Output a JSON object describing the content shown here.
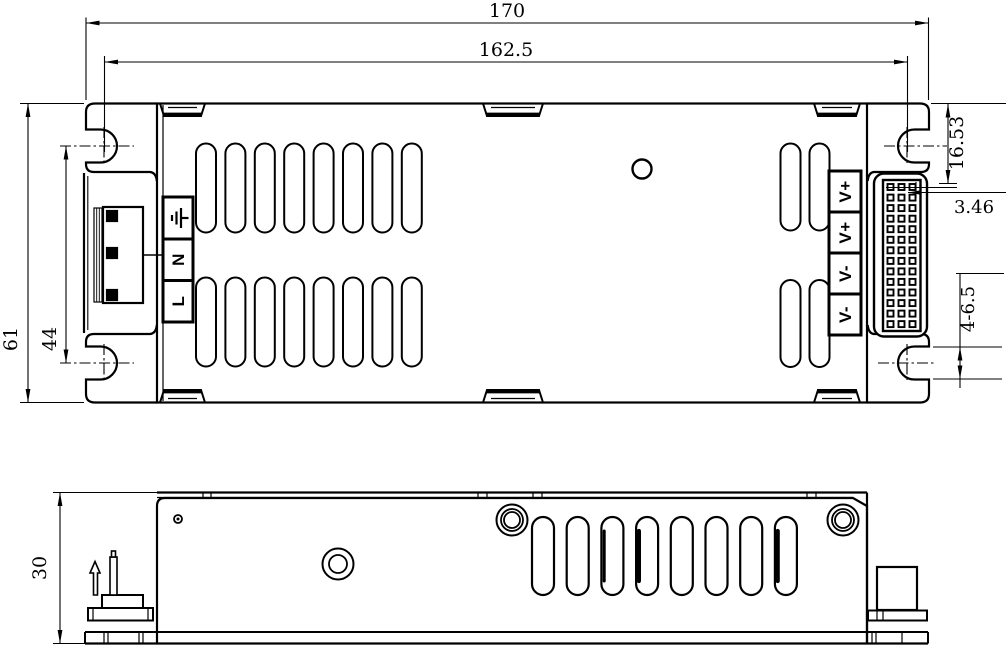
{
  "views": {
    "top": {
      "dims": {
        "overall_length": "170",
        "slot_span_length": "162.5",
        "overall_width": "61",
        "slot_span_width": "44",
        "output_offset": "16.53",
        "pin_pitch": "3.46",
        "mount_slots": "4-6.5"
      },
      "input_terminal_labels": [
        "N",
        "L"
      ],
      "input_ground_icon": "earth-ground",
      "output_terminal_labels": [
        "V+",
        "V+",
        "V-",
        "V-"
      ]
    },
    "side": {
      "dims": {
        "height": "30"
      }
    }
  },
  "colors": {
    "line": "#000000",
    "background": "#ffffff"
  }
}
